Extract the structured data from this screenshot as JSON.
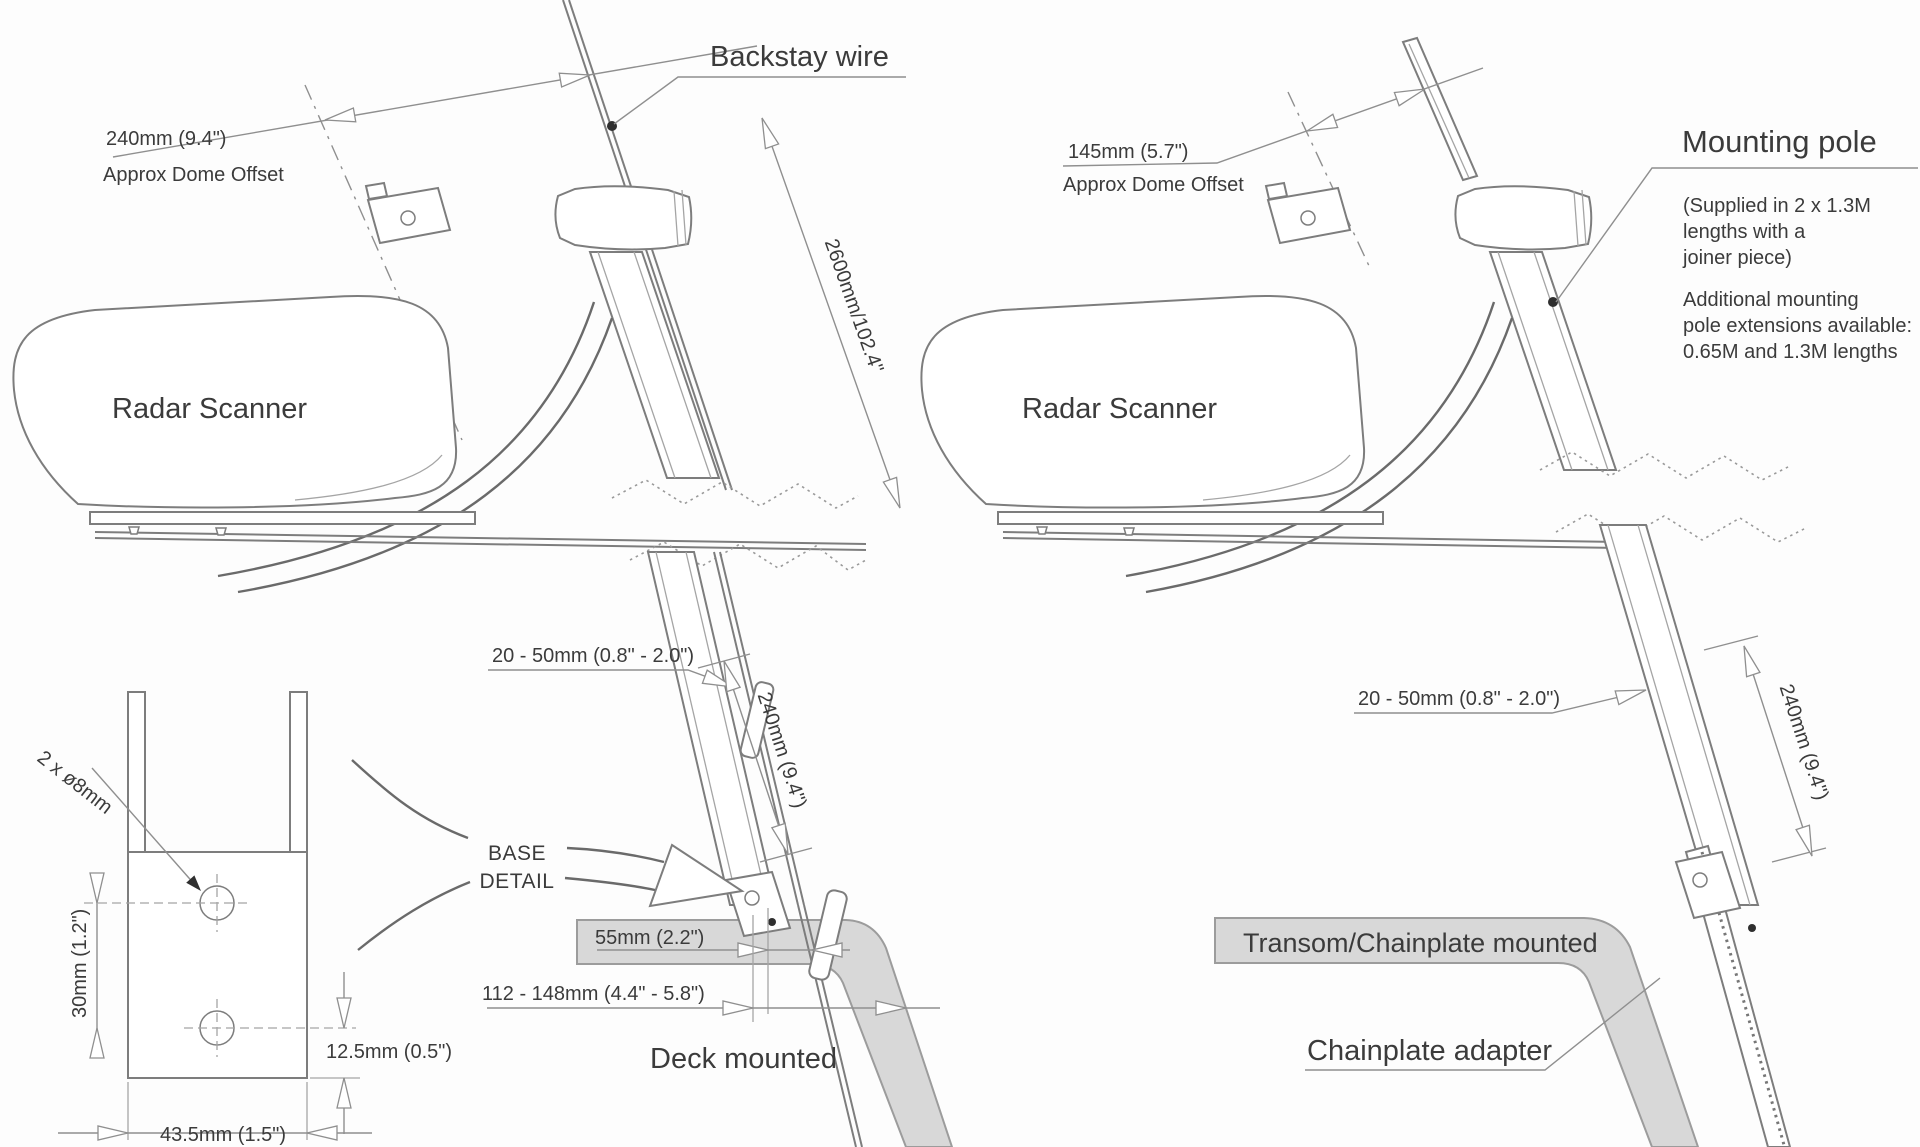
{
  "left_diagram": {
    "backstay_label": "Backstay wire",
    "offset_value": "240mm (9.4\")",
    "offset_caption": "Approx Dome Offset",
    "scanner_label": "Radar Scanner",
    "backstay_length": "2600mm/102.4\"",
    "clearance": "20 - 50mm (0.8\" - 2.0\")",
    "pole_length": "240mm (9.4\")",
    "deck_offset": "55mm (2.2\")",
    "deck_range": "112 - 148mm (4.4\" - 5.8\")",
    "caption": "Deck mounted"
  },
  "right_diagram": {
    "pole_label": "Mounting pole",
    "pole_note": [
      "(Supplied in 2 x 1.3M",
      "lengths with a",
      "joiner piece)"
    ],
    "pole_note2": [
      "Additional mounting",
      "pole extensions available:",
      "0.65M and 1.3M lengths"
    ],
    "offset_value": "145mm (5.7\")",
    "offset_caption": "Approx Dome Offset",
    "scanner_label": "Radar Scanner",
    "clearance": "20 - 50mm (0.8\" - 2.0\")",
    "pole_length": "240mm (9.4\")",
    "transom_caption": "Transom/Chainplate mounted",
    "chainplate_label": "Chainplate adapter"
  },
  "base_detail": {
    "label": [
      "BASE",
      "DETAIL"
    ],
    "holes": "2 x ø8mm",
    "hole_spacing": "30mm (1.2\")",
    "edge_distance": "12.5mm (0.5\")",
    "width": "43.5mm (1.5\")"
  }
}
